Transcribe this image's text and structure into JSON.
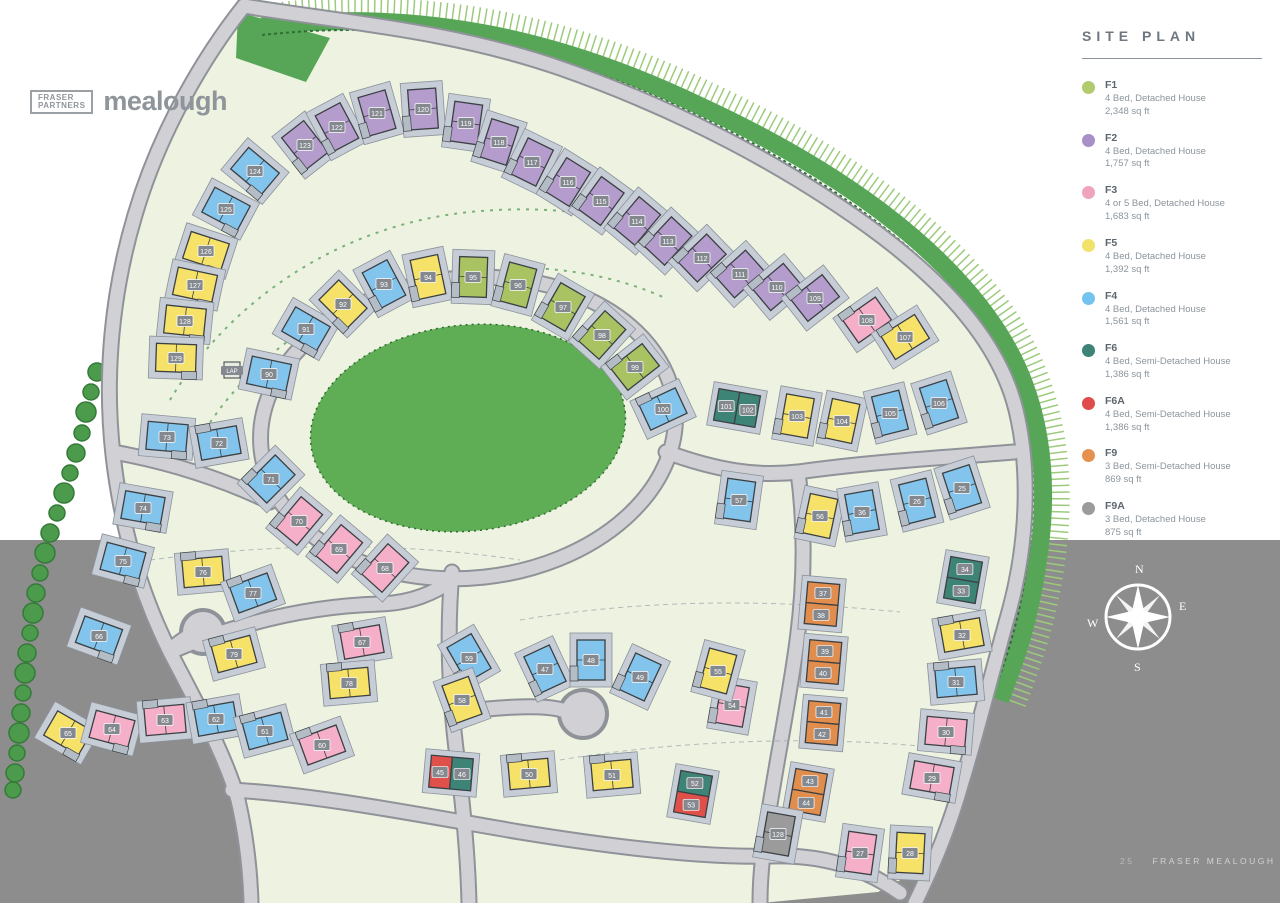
{
  "page": {
    "outside_color": "#8d8d8d",
    "field_color": "#edf3e0"
  },
  "logo": {
    "brand_line1": "FRASER",
    "brand_line2": "PARTNERS",
    "site_name": "mealough"
  },
  "legend": {
    "title": "SITE PLAN",
    "items": [
      {
        "id": "F1",
        "color": "#b2cb6d",
        "desc": "4 Bed, Detached House",
        "size": "2,348 sq ft"
      },
      {
        "id": "F2",
        "color": "#a98fc7",
        "desc": "4 Bed, Detached House",
        "size": "1,757 sq ft"
      },
      {
        "id": "F3",
        "color": "#f0a3bf",
        "desc": "4 or 5 Bed, Detached House",
        "size": "1,683 sq ft"
      },
      {
        "id": "F5",
        "color": "#f0e26a",
        "desc": "4 Bed, Detached House",
        "size": "1,392 sq ft"
      },
      {
        "id": "F4",
        "color": "#74c2ee",
        "desc": "4 Bed, Detached House",
        "size": "1,561 sq ft"
      },
      {
        "id": "F6",
        "color": "#3d8376",
        "desc": "4 Bed, Semi-Detached House",
        "size": "1,386 sq ft"
      },
      {
        "id": "F6A",
        "color": "#e04b4b",
        "desc": "4 Bed, Semi-Detached House",
        "size": "1,386 sq ft"
      },
      {
        "id": "F9",
        "color": "#e6924f",
        "desc": "3 Bed, Semi-Detached House",
        "size": "869 sq ft"
      },
      {
        "id": "F9A",
        "color": "#9b9b9b",
        "desc": "3 Bed, Detached House",
        "size": "875 sq ft"
      }
    ]
  },
  "compass": {
    "n": "N",
    "e": "E",
    "s": "S",
    "w": "W"
  },
  "footer": {
    "page_number": "25",
    "text": "FRASER MEALOUGH"
  },
  "map": {
    "types": {
      "F1": "#a9c262",
      "F2": "#b49ccd",
      "F3": "#f5afc9",
      "F5": "#f6e268",
      "F4": "#82c4ec",
      "F6": "#3d8376",
      "F6A": "#e0504b",
      "F9": "#e08d4e",
      "F9A": "#9b9b9b"
    },
    "lap_label": "LAP",
    "houses": [
      {
        "n": "123",
        "t": "F2",
        "x": 305,
        "y": 145,
        "r": -38
      },
      {
        "n": "122",
        "t": "F2",
        "x": 337,
        "y": 127,
        "r": -28
      },
      {
        "n": "121",
        "t": "F2",
        "x": 377,
        "y": 113,
        "r": -16
      },
      {
        "n": "120",
        "t": "F2",
        "x": 423,
        "y": 109,
        "r": -4
      },
      {
        "n": "119",
        "t": "F2",
        "x": 466,
        "y": 123,
        "r": 8
      },
      {
        "n": "118",
        "t": "F2",
        "x": 499,
        "y": 142,
        "r": 18
      },
      {
        "n": "117",
        "t": "F2",
        "x": 532,
        "y": 162,
        "r": 26
      },
      {
        "n": "116",
        "t": "F2",
        "x": 568,
        "y": 182,
        "r": 32
      },
      {
        "n": "115",
        "t": "F2",
        "x": 601,
        "y": 201,
        "r": 36
      },
      {
        "n": "114",
        "t": "F2",
        "x": 637,
        "y": 221,
        "r": 40
      },
      {
        "n": "113",
        "t": "F2",
        "x": 668,
        "y": 241,
        "r": 43
      },
      {
        "n": "112",
        "t": "F2",
        "x": 702,
        "y": 258,
        "r": 46
      },
      {
        "n": "111",
        "t": "F2",
        "x": 740,
        "y": 274,
        "r": 48
      },
      {
        "n": "110",
        "t": "F2",
        "x": 777,
        "y": 287,
        "r": 50
      },
      {
        "n": "109",
        "t": "F2",
        "x": 815,
        "y": 298,
        "r": 52
      },
      {
        "n": "108",
        "t": "F3",
        "x": 867,
        "y": 320,
        "r": 55
      },
      {
        "n": "107",
        "t": "F5",
        "x": 905,
        "y": 337,
        "r": 58
      },
      {
        "n": "124",
        "t": "F4",
        "x": 255,
        "y": 171,
        "r": -50
      },
      {
        "n": "125",
        "t": "F4",
        "x": 226,
        "y": 209,
        "r": -62
      },
      {
        "n": "126",
        "t": "F5",
        "x": 206,
        "y": 251,
        "r": -72
      },
      {
        "n": "127",
        "t": "F5",
        "x": 195,
        "y": 285,
        "r": -78
      },
      {
        "n": "128",
        "t": "F5",
        "x": 185,
        "y": 321,
        "r": -84
      },
      {
        "n": "129",
        "t": "F5",
        "x": 176,
        "y": 358,
        "r": -88
      },
      {
        "n": "90",
        "t": "F4",
        "x": 269,
        "y": 374,
        "r": -78
      },
      {
        "n": "91",
        "t": "F4",
        "x": 306,
        "y": 329,
        "r": -60
      },
      {
        "n": "92",
        "t": "F5",
        "x": 343,
        "y": 304,
        "r": -45
      },
      {
        "n": "93",
        "t": "F4",
        "x": 384,
        "y": 284,
        "r": -28
      },
      {
        "n": "94",
        "t": "F5",
        "x": 428,
        "y": 277,
        "r": -12
      },
      {
        "n": "95",
        "t": "F1",
        "x": 473,
        "y": 277,
        "r": 2
      },
      {
        "n": "96",
        "t": "F1",
        "x": 518,
        "y": 285,
        "r": 15
      },
      {
        "n": "97",
        "t": "F1",
        "x": 563,
        "y": 307,
        "r": 30
      },
      {
        "n": "98",
        "t": "F1",
        "x": 602,
        "y": 335,
        "r": 42
      },
      {
        "n": "99",
        "t": "F1",
        "x": 635,
        "y": 367,
        "r": 52
      },
      {
        "n": "100",
        "t": "F4",
        "x": 663,
        "y": 409,
        "r": 65
      },
      {
        "n": "101",
        "n2": "102",
        "t": "F6",
        "t2": "F6",
        "x": 737,
        "y": 408,
        "r": 10,
        "semi": true
      },
      {
        "n": "103",
        "t": "F5",
        "x": 797,
        "y": 416,
        "r": 10
      },
      {
        "n": "104",
        "t": "F5",
        "x": 842,
        "y": 421,
        "r": 12
      },
      {
        "n": "105",
        "t": "F4",
        "x": 890,
        "y": 413,
        "r": -14
      },
      {
        "n": "106",
        "t": "F4",
        "x": 939,
        "y": 403,
        "r": -18
      },
      {
        "n": "73",
        "t": "F4",
        "x": 167,
        "y": 437,
        "r": -85
      },
      {
        "n": "72",
        "t": "F4",
        "x": 219,
        "y": 443,
        "r": 80
      },
      {
        "n": "71",
        "t": "F4",
        "x": 271,
        "y": 479,
        "r": 45
      },
      {
        "n": "74",
        "t": "F4",
        "x": 143,
        "y": 508,
        "r": -80
      },
      {
        "n": "75",
        "t": "F4",
        "x": 123,
        "y": 561,
        "r": -75
      },
      {
        "n": "76",
        "t": "F5",
        "x": 203,
        "y": 572,
        "r": 85
      },
      {
        "n": "77",
        "t": "F4",
        "x": 253,
        "y": 593,
        "r": 70
      },
      {
        "n": "70",
        "t": "F3",
        "x": 299,
        "y": 521,
        "r": 40
      },
      {
        "n": "69",
        "t": "F3",
        "x": 339,
        "y": 549,
        "r": 40
      },
      {
        "n": "68",
        "t": "F3",
        "x": 385,
        "y": 568,
        "r": 42
      },
      {
        "n": "67",
        "t": "F3",
        "x": 362,
        "y": 642,
        "r": 80
      },
      {
        "n": "78",
        "t": "F5",
        "x": 349,
        "y": 683,
        "r": 85
      },
      {
        "n": "79",
        "t": "F5",
        "x": 234,
        "y": 654,
        "r": 75
      },
      {
        "n": "66",
        "t": "F4",
        "x": 99,
        "y": 636,
        "r": -70
      },
      {
        "n": "65",
        "t": "F5",
        "x": 68,
        "y": 733,
        "r": -60
      },
      {
        "n": "64",
        "t": "F3",
        "x": 112,
        "y": 729,
        "r": -75
      },
      {
        "n": "63",
        "t": "F3",
        "x": 165,
        "y": 720,
        "r": 85
      },
      {
        "n": "62",
        "t": "F4",
        "x": 216,
        "y": 719,
        "r": 80
      },
      {
        "n": "61",
        "t": "F4",
        "x": 265,
        "y": 731,
        "r": 75
      },
      {
        "n": "60",
        "t": "F3",
        "x": 322,
        "y": 745,
        "r": 70
      },
      {
        "n": "59",
        "t": "F4",
        "x": 469,
        "y": 658,
        "r": -30
      },
      {
        "n": "58",
        "t": "F5",
        "x": 462,
        "y": 700,
        "r": -20
      },
      {
        "n": "45",
        "n2": "46",
        "t": "F6A",
        "t2": "F6",
        "x": 451,
        "y": 773,
        "r": 5,
        "semi": true
      },
      {
        "n": "47",
        "t": "F4",
        "x": 545,
        "y": 669,
        "r": -25
      },
      {
        "n": "48",
        "t": "F4",
        "x": 591,
        "y": 660,
        "r": 0
      },
      {
        "n": "49",
        "t": "F4",
        "x": 640,
        "y": 677,
        "r": 25
      },
      {
        "n": "50",
        "t": "F5",
        "x": 529,
        "y": 774,
        "r": 85
      },
      {
        "n": "51",
        "t": "F5",
        "x": 612,
        "y": 775,
        "r": 85
      },
      {
        "n": "52",
        "n2": "53",
        "t": "F6",
        "t2": "F6A",
        "x": 693,
        "y": 794,
        "r": 100,
        "semi": true
      },
      {
        "n": "54",
        "t": "F3",
        "x": 732,
        "y": 705,
        "r": 10
      },
      {
        "n": "55",
        "t": "F5",
        "x": 718,
        "y": 671,
        "r": 15
      },
      {
        "n": "57",
        "t": "F4",
        "x": 739,
        "y": 500,
        "r": 8
      },
      {
        "n": "56",
        "t": "F5",
        "x": 820,
        "y": 516,
        "r": 12
      },
      {
        "n": "36",
        "t": "F4",
        "x": 862,
        "y": 512,
        "r": -10
      },
      {
        "n": "26",
        "t": "F4",
        "x": 917,
        "y": 501,
        "r": -14
      },
      {
        "n": "25",
        "t": "F4",
        "x": 962,
        "y": 488,
        "r": -18
      },
      {
        "n": "34",
        "n2": "33",
        "t": "F6",
        "t2": "F6",
        "x": 963,
        "y": 580,
        "r": 100,
        "semi": true
      },
      {
        "n": "32",
        "t": "F5",
        "x": 962,
        "y": 635,
        "r": 80
      },
      {
        "n": "31",
        "t": "F4",
        "x": 956,
        "y": 682,
        "r": 85
      },
      {
        "n": "30",
        "t": "F3",
        "x": 946,
        "y": 732,
        "r": -85
      },
      {
        "n": "29",
        "t": "F3",
        "x": 932,
        "y": 778,
        "r": -80
      },
      {
        "n": "27",
        "t": "F3",
        "x": 860,
        "y": 853,
        "r": 8
      },
      {
        "n": "28",
        "t": "F5",
        "x": 910,
        "y": 853,
        "r": 3
      },
      {
        "n": "37",
        "n2": "38",
        "t": "F9",
        "t2": "F9",
        "x": 822,
        "y": 604,
        "r": 95,
        "semi": true
      },
      {
        "n": "39",
        "n2": "40",
        "t": "F9",
        "t2": "F9",
        "x": 824,
        "y": 662,
        "r": 95,
        "semi": true
      },
      {
        "n": "41",
        "n2": "42",
        "t": "F9",
        "t2": "F9",
        "x": 823,
        "y": 723,
        "r": 95,
        "semi": true
      },
      {
        "n": "43",
        "n2": "44",
        "t": "F9",
        "t2": "F9",
        "x": 808,
        "y": 792,
        "r": 100,
        "semi": true
      },
      {
        "n": "128",
        "t": "F9A",
        "x": 778,
        "y": 834,
        "r": 10
      }
    ]
  }
}
